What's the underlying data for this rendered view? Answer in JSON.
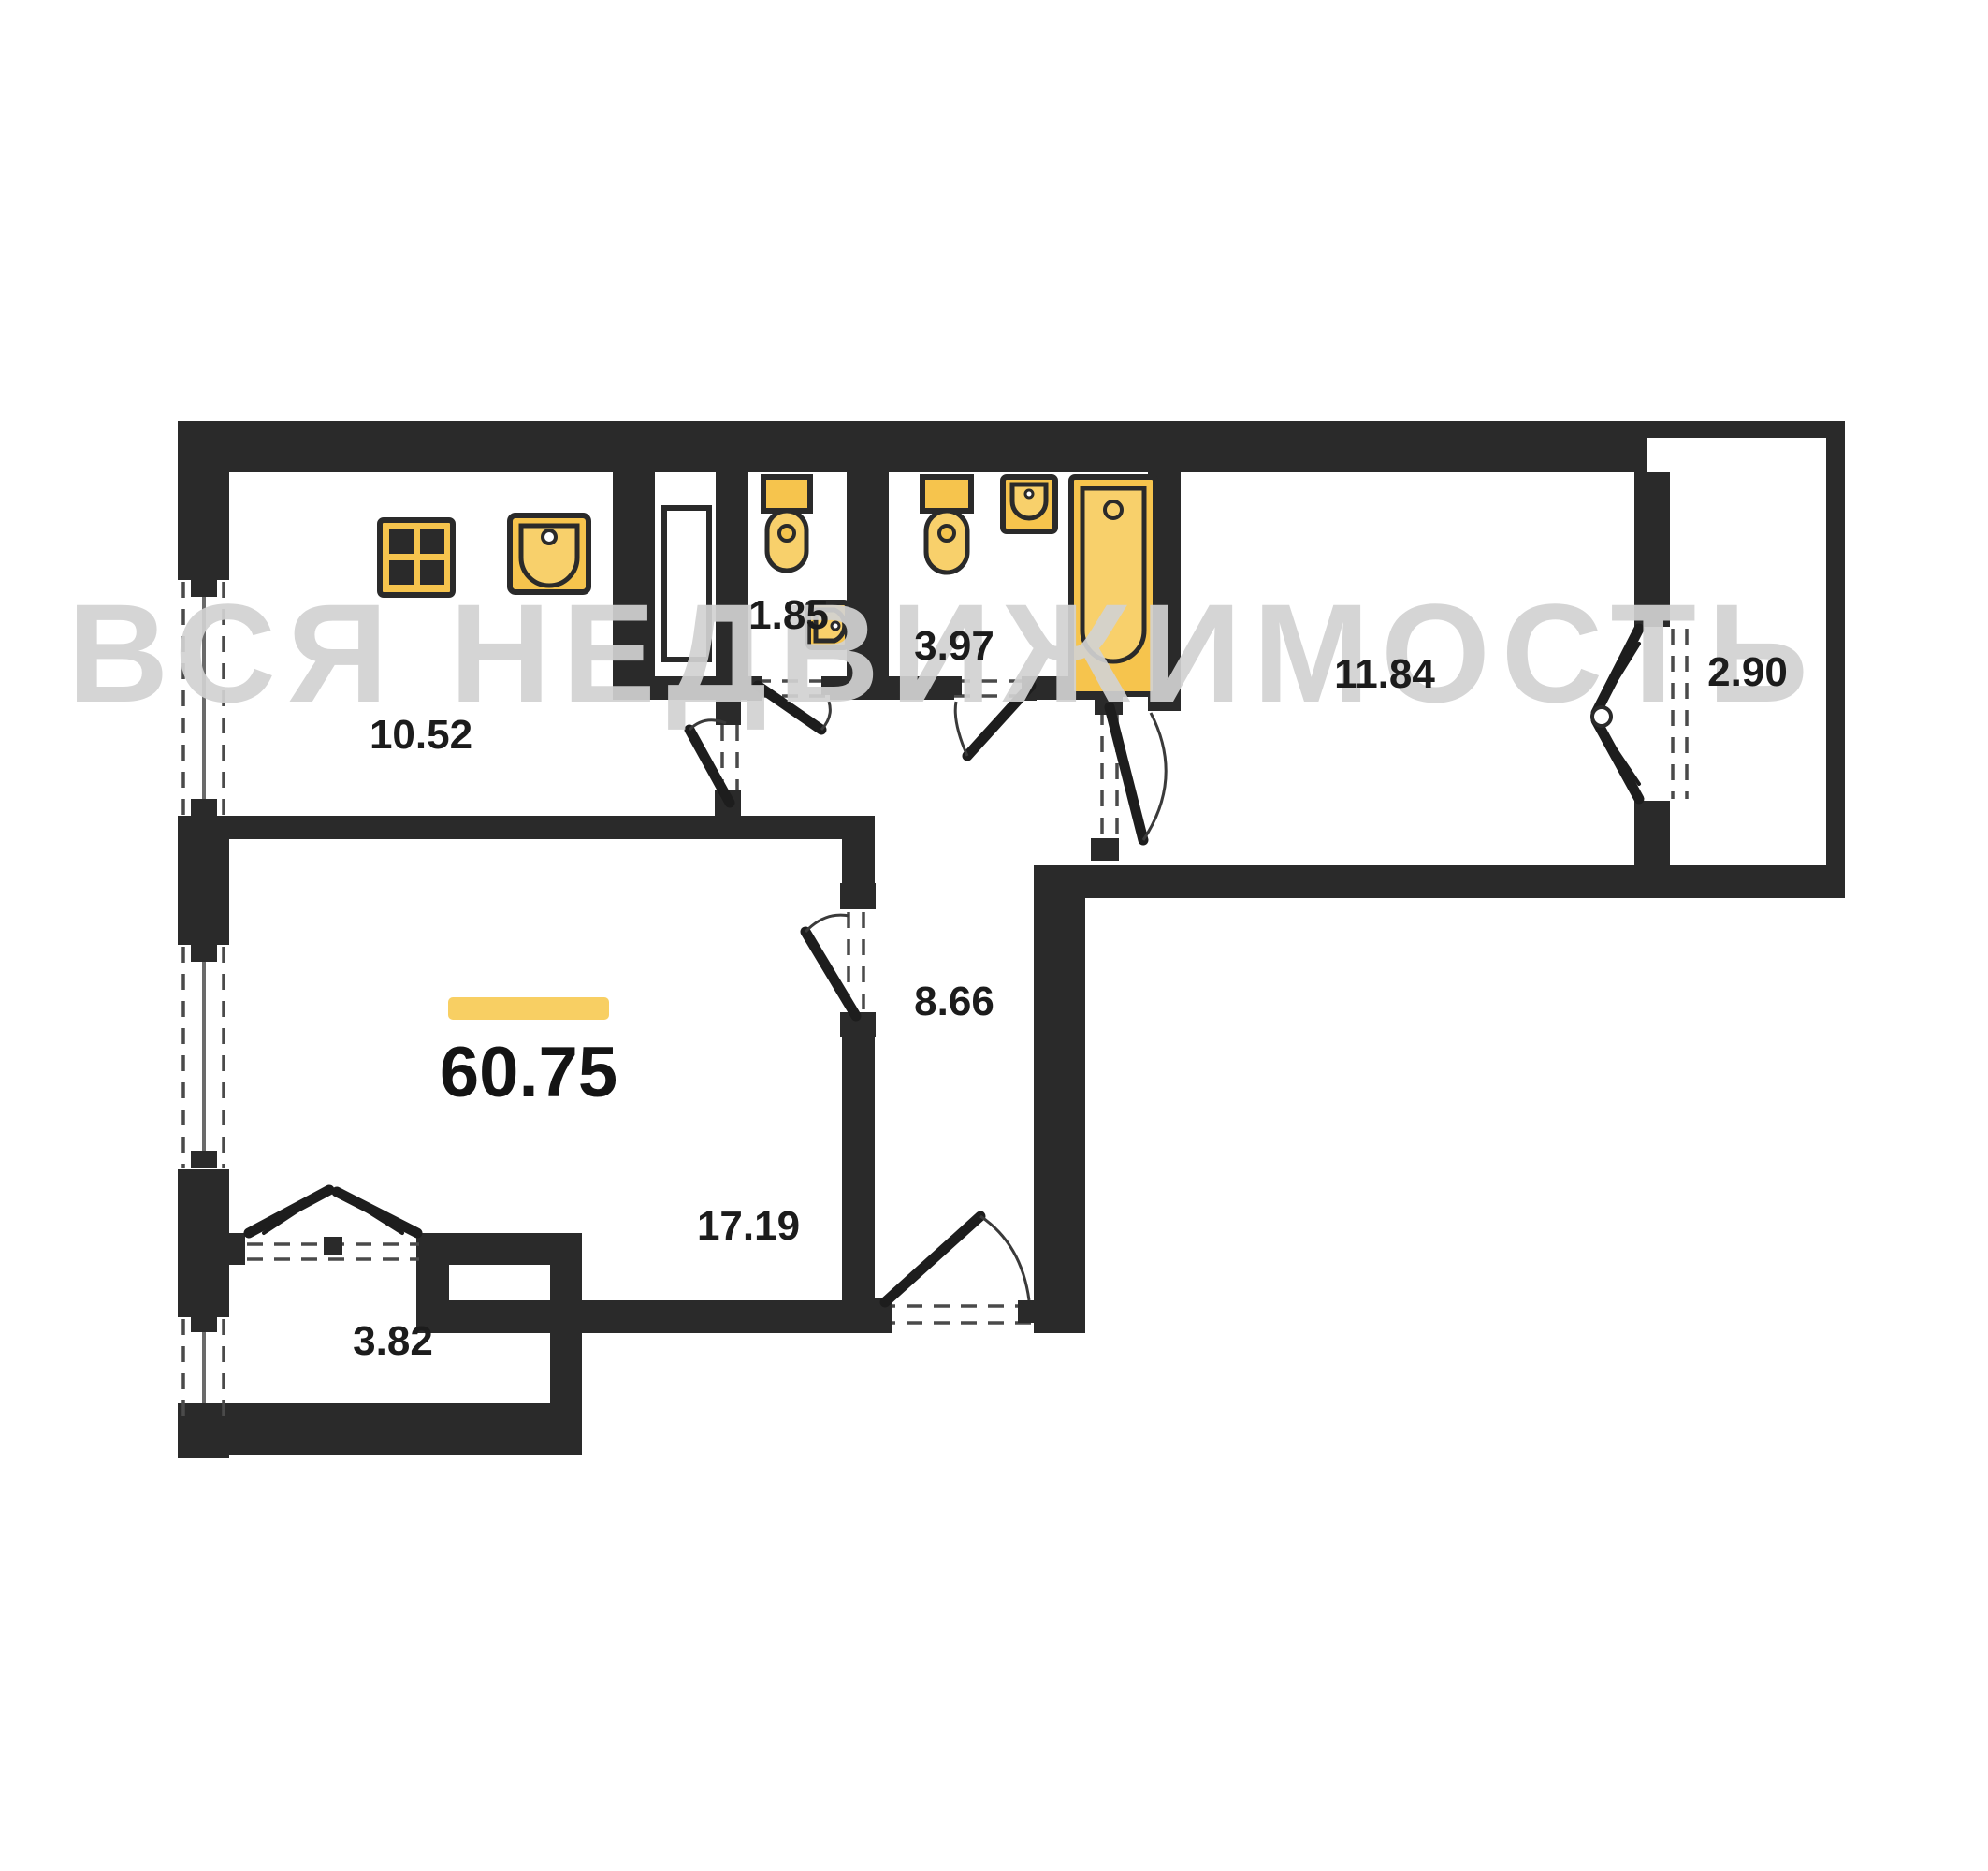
{
  "watermark": "ВСЯ НЕДВИЖИМОСТЬ",
  "total": {
    "area": "60.75"
  },
  "rooms": [
    {
      "name": "kitchen",
      "area": "10.52"
    },
    {
      "name": "wc",
      "area": "1.85"
    },
    {
      "name": "bathroom",
      "area": "3.97"
    },
    {
      "name": "bedroom",
      "area": "11.84"
    },
    {
      "name": "balcony-right",
      "area": "2.90"
    },
    {
      "name": "hallway",
      "area": "8.66"
    },
    {
      "name": "living-room",
      "area": "17.19"
    },
    {
      "name": "balcony-lower",
      "area": "3.82"
    }
  ],
  "colors": {
    "wall": "#2a2a2a",
    "fixture": "#f6c44d",
    "accent_bar": "#f8cf63",
    "watermark_gray": "#d1d1d1",
    "background": "#ffffff"
  },
  "fixtures": [
    "stove-icon",
    "kitchen-sink-icon",
    "wc-toilet-icon",
    "wc-corner-sink-icon",
    "bath-toilet-icon",
    "bath-wall-sink-icon",
    "bathtub-icon"
  ]
}
